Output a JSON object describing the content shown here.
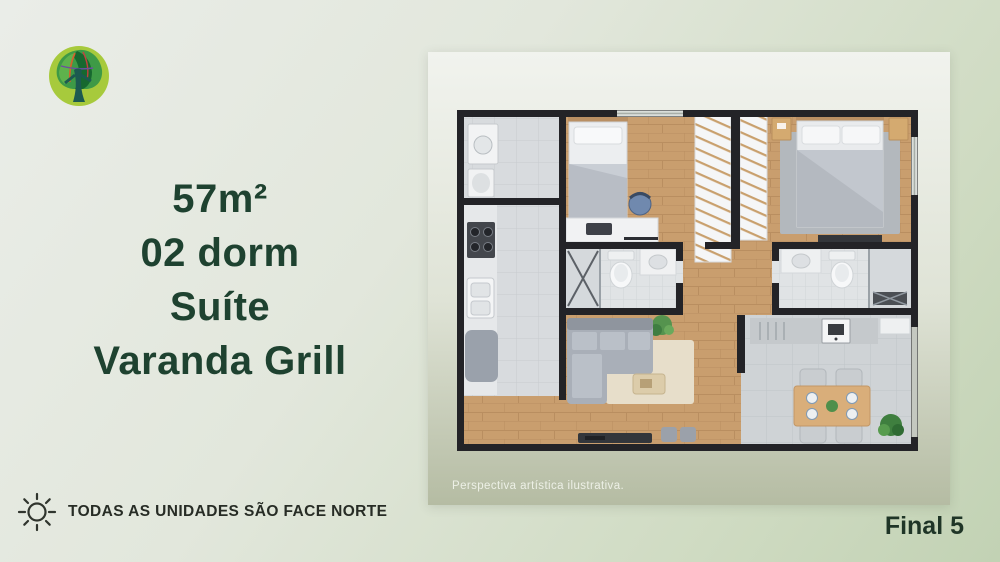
{
  "slide": {
    "headline": {
      "line1": "57m²",
      "line2": "02 dorm",
      "line3": "Suíte",
      "line4": "Varanda Grill"
    },
    "floorplan": {
      "caption": "Perspectiva artística ilustrativa."
    },
    "footer": {
      "orientation_note": "TODAS AS UNIDADES SÃO FACE NORTE",
      "unit_label": "Final 5"
    },
    "icons": {
      "logo": "tree-logo-icon",
      "sun": "sun-icon"
    },
    "colors": {
      "headline_text": "#1e4230",
      "footer_text": "#272c25",
      "background_top_left": "#eaede8",
      "background_bottom_right": "#c2d2b4",
      "plan_background_top": "#f1f3ee",
      "plan_background_bottom": "#b5bca3",
      "wall": "#232327",
      "wood_floor": "#c99e6e",
      "logo_circle": "#a7ca3c"
    }
  }
}
